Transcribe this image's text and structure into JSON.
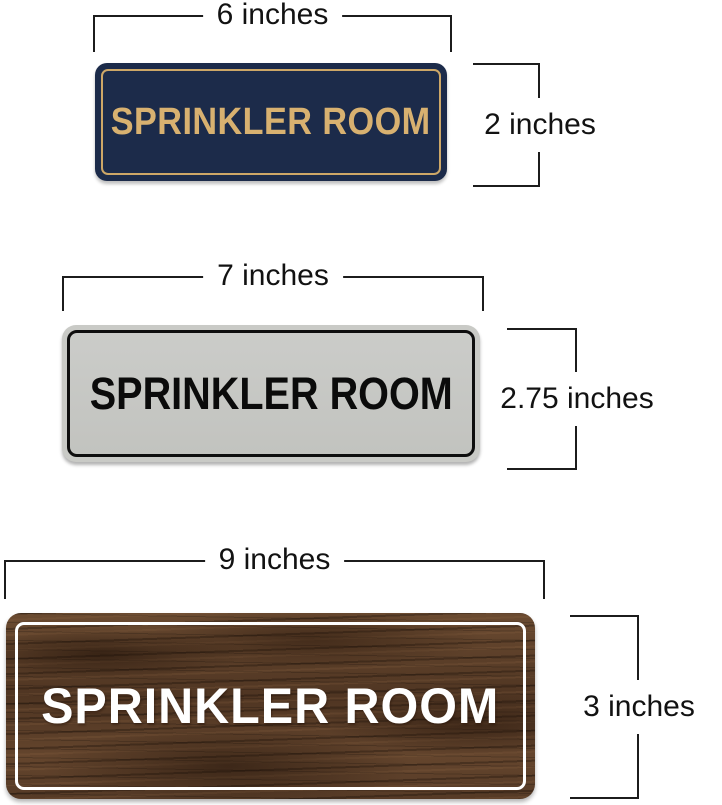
{
  "image_type": "product-dimension-diagram",
  "dimension_line_color": "#1c1c1c",
  "signs": [
    {
      "name": "navy-gold-sign",
      "text": "SPRINKLER ROOM",
      "width_label": "6 inches",
      "height_label": "2 inches",
      "colors": {
        "background": "#1c2b4a",
        "border": "#cda767",
        "text": "#d8b170"
      }
    },
    {
      "name": "silver-black-sign",
      "text": "SPRINKLER ROOM",
      "width_label": "7 inches",
      "height_label": "2.75 inches",
      "colors": {
        "background": "#c7c8c4",
        "border": "#0e0e0e",
        "text": "#0b0b0b"
      }
    },
    {
      "name": "walnut-wood-sign",
      "text": "SPRINKLER ROOM",
      "width_label": "9 inches",
      "height_label": "3 inches",
      "colors": {
        "background": "#5a3e29",
        "border": "#ffffff",
        "text": "#ffffff"
      }
    }
  ]
}
